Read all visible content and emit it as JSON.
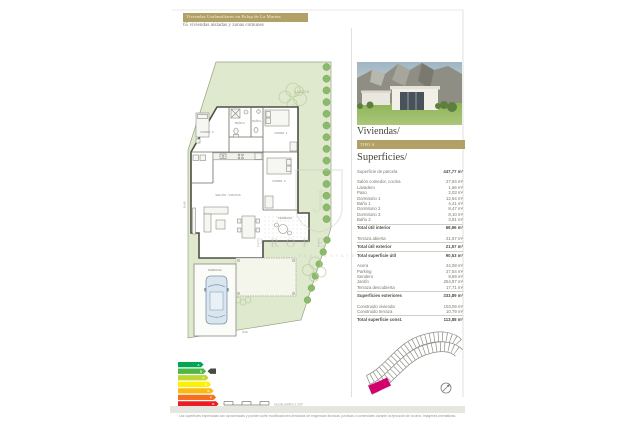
{
  "header": {
    "title": "Viviendas Unifamiliares en Polop de La Marina",
    "subtitle": "65 viviendas aisladas y zonas comunes"
  },
  "right_panel": {
    "section_viviendas": "Viviendas/",
    "type_badge": "TIPO A",
    "section_superficies": "Superficies/"
  },
  "surfaces": {
    "parcel": {
      "label": "Superficie de parcela",
      "value": "447,77 m²"
    },
    "interior": [
      {
        "label": "Salón comedor, cocina",
        "value": "27,84 m²"
      },
      {
        "label": "Lavadero",
        "value": "1,66 m²"
      },
      {
        "label": "Paso",
        "value": "2,03 m²"
      },
      {
        "label": "Dormitorio 1",
        "value": "12,64 m²"
      },
      {
        "label": "Baño 1",
        "value": "4,41 m²"
      },
      {
        "label": "Dormitorio 2",
        "value": "8,47 m²"
      },
      {
        "label": "Dormitorio 3",
        "value": "8,10 m²"
      },
      {
        "label": "Baño 2",
        "value": "3,81 m²"
      }
    ],
    "interior_total": {
      "label": "Total útil interior",
      "value": "68,96 m²"
    },
    "exterior": [
      {
        "label": "Terraza abierta",
        "value": "21,57 m²"
      }
    ],
    "exterior_totals": [
      {
        "label": "Total útil exterior",
        "value": "21,57 m²"
      },
      {
        "label": "Total superficie útil",
        "value": "90,53 m²"
      }
    ],
    "outdoor": [
      {
        "label": "Acera",
        "value": "24,08 m²"
      },
      {
        "label": "Parking",
        "value": "27,54 m²"
      },
      {
        "label": "Sendero",
        "value": "9,69 m²"
      },
      {
        "label": "Jardín",
        "value": "254,87 m²"
      },
      {
        "label": "Terraza descubierta",
        "value": "17,71 m²"
      }
    ],
    "outdoor_total": {
      "label": "Superficies exteriores",
      "value": "333,89 m²"
    },
    "built": [
      {
        "label": "Construido vivienda",
        "value": "103,09 m²"
      },
      {
        "label": "Construido terraza",
        "value": "10,79 m²"
      }
    ],
    "built_total": {
      "label": "Total superficie const.",
      "value": "113,88 m²"
    }
  },
  "plan": {
    "rooms": {
      "dorm3": "DORM. 3",
      "bano2": "BAÑO 2",
      "bano1": "BAÑO 1",
      "dorm1": "DORM. 1",
      "dorm2": "DORM. 2",
      "salon": "SALÓN - COCINA",
      "terraza": "TERRAZA",
      "parking": "PARKING",
      "jardin": "JARDÍN"
    },
    "dims": {
      "left": "16,40",
      "bottom": "8,00"
    }
  },
  "energy": {
    "letters": [
      "A",
      "B",
      "C",
      "D",
      "E",
      "F",
      "G"
    ],
    "colors": [
      "#00a651",
      "#4cb848",
      "#bfd730",
      "#fff200",
      "#fdb913",
      "#f37021",
      "#ed1c24"
    ],
    "rating": "B"
  },
  "scale_label": "escala gráfica 1:200",
  "watermark": {
    "initial": "J",
    "text": "PROPE",
    "subtext": "REAL ESTATE"
  },
  "footer": {
    "disclaimer": "Las superficies expresadas son aproximadas y pueden sufrir modificaciones derivadas de exigencias técnicas, jurídicas o comerciales durante la ejecución de la obra. Imágenes orientativas."
  }
}
